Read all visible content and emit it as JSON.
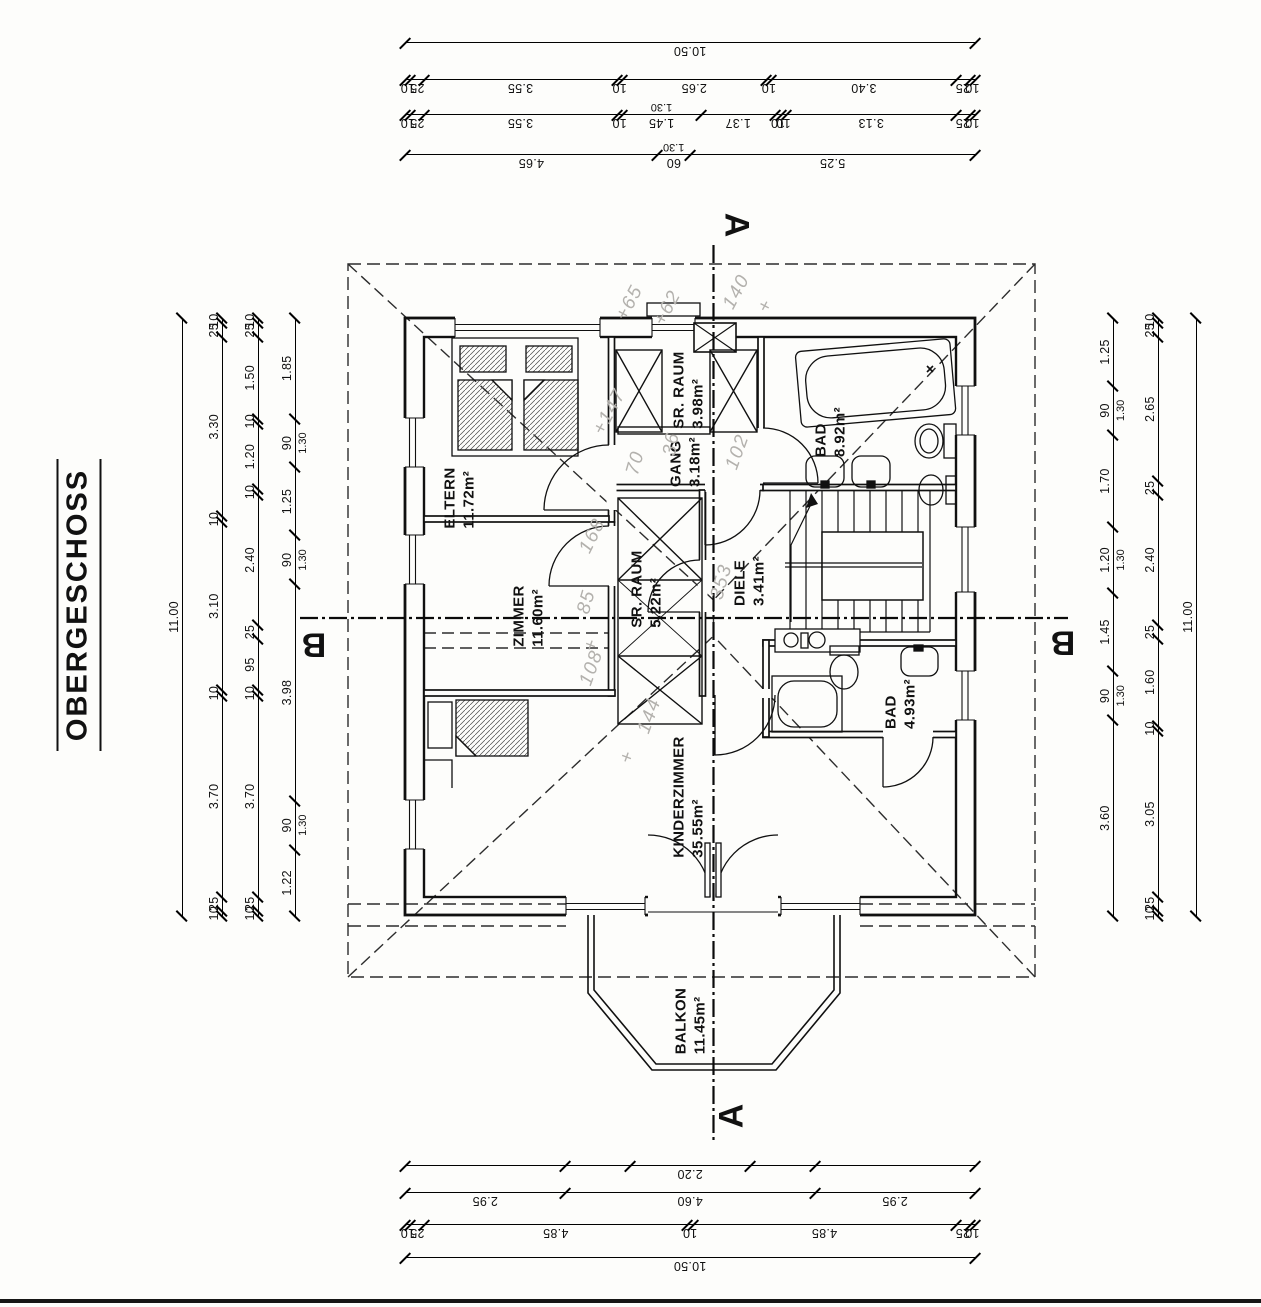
{
  "title": "OBERGESCHOSS",
  "sections": {
    "a": "A",
    "b": "B"
  },
  "rooms": [
    {
      "name": "ELTERN",
      "area": "11.72m²"
    },
    {
      "name": "SR. RAUM",
      "area": "3.98m²"
    },
    {
      "name": "GANG",
      "area": "3.18m²"
    },
    {
      "name": "BAD",
      "area": "8.92m²"
    },
    {
      "name": "ZIMMER",
      "area": "11.60m²"
    },
    {
      "name": "SR. RAUM",
      "area": "5.22m²"
    },
    {
      "name": "DIELE",
      "area": "3.41m²"
    },
    {
      "name": "BAD",
      "area": "4.93m²"
    },
    {
      "name": "KINDERZIMMER",
      "area": "35.55m²"
    },
    {
      "name": "BALKON",
      "area": "11.45m²"
    }
  ],
  "dims": {
    "top": [
      [
        "10.50"
      ],
      [
        "10",
        "25",
        "3.40",
        "10",
        "2.65",
        "10",
        "3.55",
        "25",
        "10"
      ],
      [
        "10",
        "25",
        "3.13",
        "10",
        "10",
        "1.37",
        {
          "v": "1.45",
          "sub": "1.30"
        },
        "10",
        "3.55",
        "25",
        "10"
      ],
      [
        "5.25",
        {
          "v": "60",
          "sub": "1.30"
        },
        "4.65"
      ]
    ],
    "bottom": [
      [
        {
          "v": "",
          "g": 2.95
        },
        {
          "v": "",
          "g": 1.2
        },
        "2.20",
        {
          "v": "",
          "g": 1.2
        },
        {
          "v": "",
          "g": 2.95
        }
      ],
      [
        "2.95",
        "4.60",
        "2.95"
      ],
      [
        "10",
        "25",
        "4.85",
        "10",
        "4.85",
        "25",
        "10"
      ],
      [
        "10.50"
      ]
    ],
    "left": [
      [
        "11.00"
      ],
      [
        "10",
        "25",
        "3.30",
        "10",
        "3.10",
        "10",
        "3.70",
        "25",
        "10"
      ],
      [
        "10",
        "25",
        "1.50",
        "10",
        "1.20",
        "10",
        "2.40",
        "25",
        "95",
        "10",
        "3.70",
        "25",
        "10"
      ],
      [
        "1.85",
        {
          "v": "90",
          "sub": "1.30"
        },
        "1.25",
        {
          "v": "90",
          "sub": "1.30"
        },
        "3.98",
        {
          "v": "90",
          "sub": "1.30"
        },
        "1.22"
      ]
    ],
    "right": [
      [
        "1.25",
        {
          "v": "90",
          "sub": "1.30"
        },
        "1.70",
        {
          "v": "1.20",
          "sub": "1.30"
        },
        "1.45",
        {
          "v": "90",
          "sub": "1.30"
        },
        "3.60"
      ],
      [
        "10",
        "25",
        "2.65",
        "25",
        "2.40",
        "25",
        "1.60",
        "10",
        "3.05",
        "25",
        "10"
      ],
      [
        "11.00"
      ]
    ]
  },
  "annotations": [
    {
      "t": "+65",
      "x": 630,
      "y": 303,
      "r": -62
    },
    {
      "t": "+62",
      "x": 668,
      "y": 308,
      "r": -62
    },
    {
      "t": "140",
      "x": 737,
      "y": 292,
      "r": -62
    },
    {
      "t": "+",
      "x": 766,
      "y": 306,
      "r": -62
    },
    {
      "t": "+147",
      "x": 610,
      "y": 412,
      "r": -62
    },
    {
      "t": "70",
      "x": 636,
      "y": 463,
      "r": -74
    },
    {
      "t": "36",
      "x": 672,
      "y": 444,
      "r": -80
    },
    {
      "t": "102",
      "x": 738,
      "y": 452,
      "r": -70
    },
    {
      "t": "168",
      "x": 593,
      "y": 536,
      "r": -64
    },
    {
      "t": "85",
      "x": 587,
      "y": 602,
      "r": -74
    },
    {
      "t": "+",
      "x": 592,
      "y": 645,
      "r": -70
    },
    {
      "t": "108",
      "x": 592,
      "y": 668,
      "r": -70
    },
    {
      "t": "353",
      "x": 722,
      "y": 582,
      "r": -74
    },
    {
      "t": "+",
      "x": 628,
      "y": 757,
      "r": -70
    },
    {
      "t": "144",
      "x": 650,
      "y": 716,
      "r": -70
    }
  ]
}
